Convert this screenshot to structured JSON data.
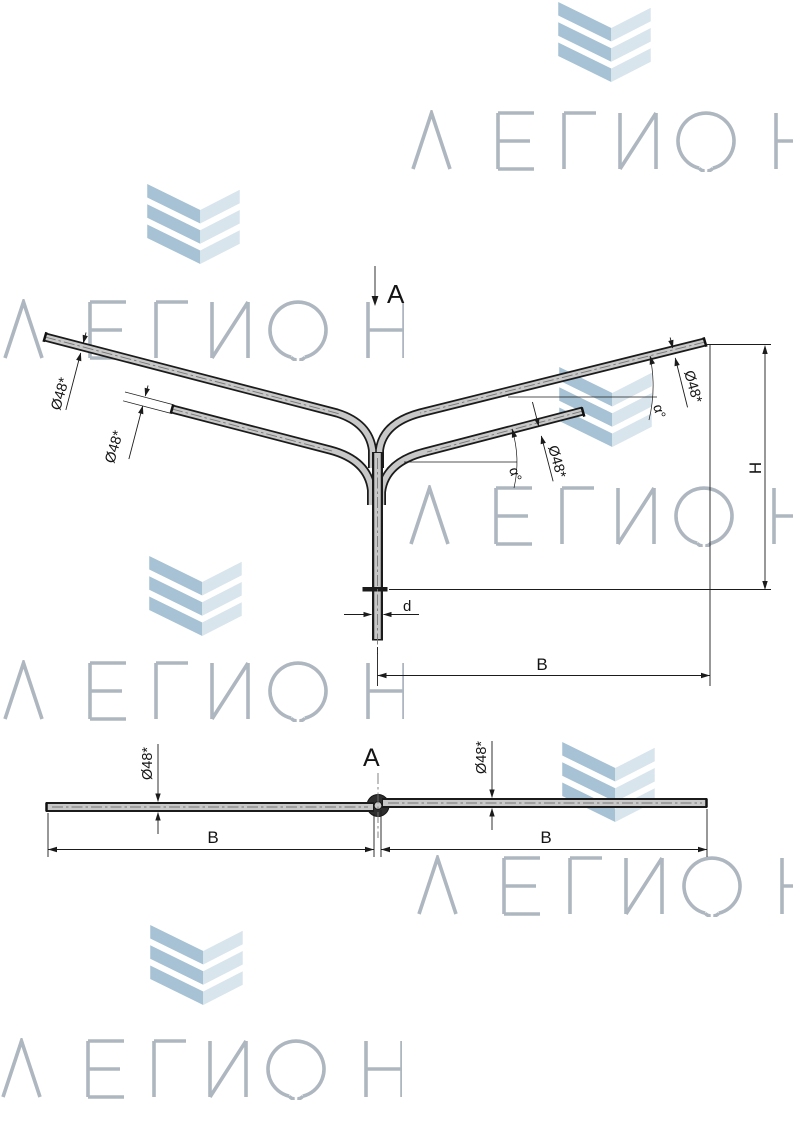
{
  "watermark": {
    "text": "ЛЕГИОН"
  },
  "brand": {
    "chevron_color_dark": "#a6c2d4",
    "chevron_color_light": "#d8e5ed",
    "wordmark_color": "#aeb7bf"
  },
  "drawing": {
    "section_label": "A",
    "view_label": "A",
    "labels": {
      "diameter": "Ø48*",
      "angle": "α°",
      "height": "H",
      "span": "B",
      "post_diameter": "d"
    }
  }
}
